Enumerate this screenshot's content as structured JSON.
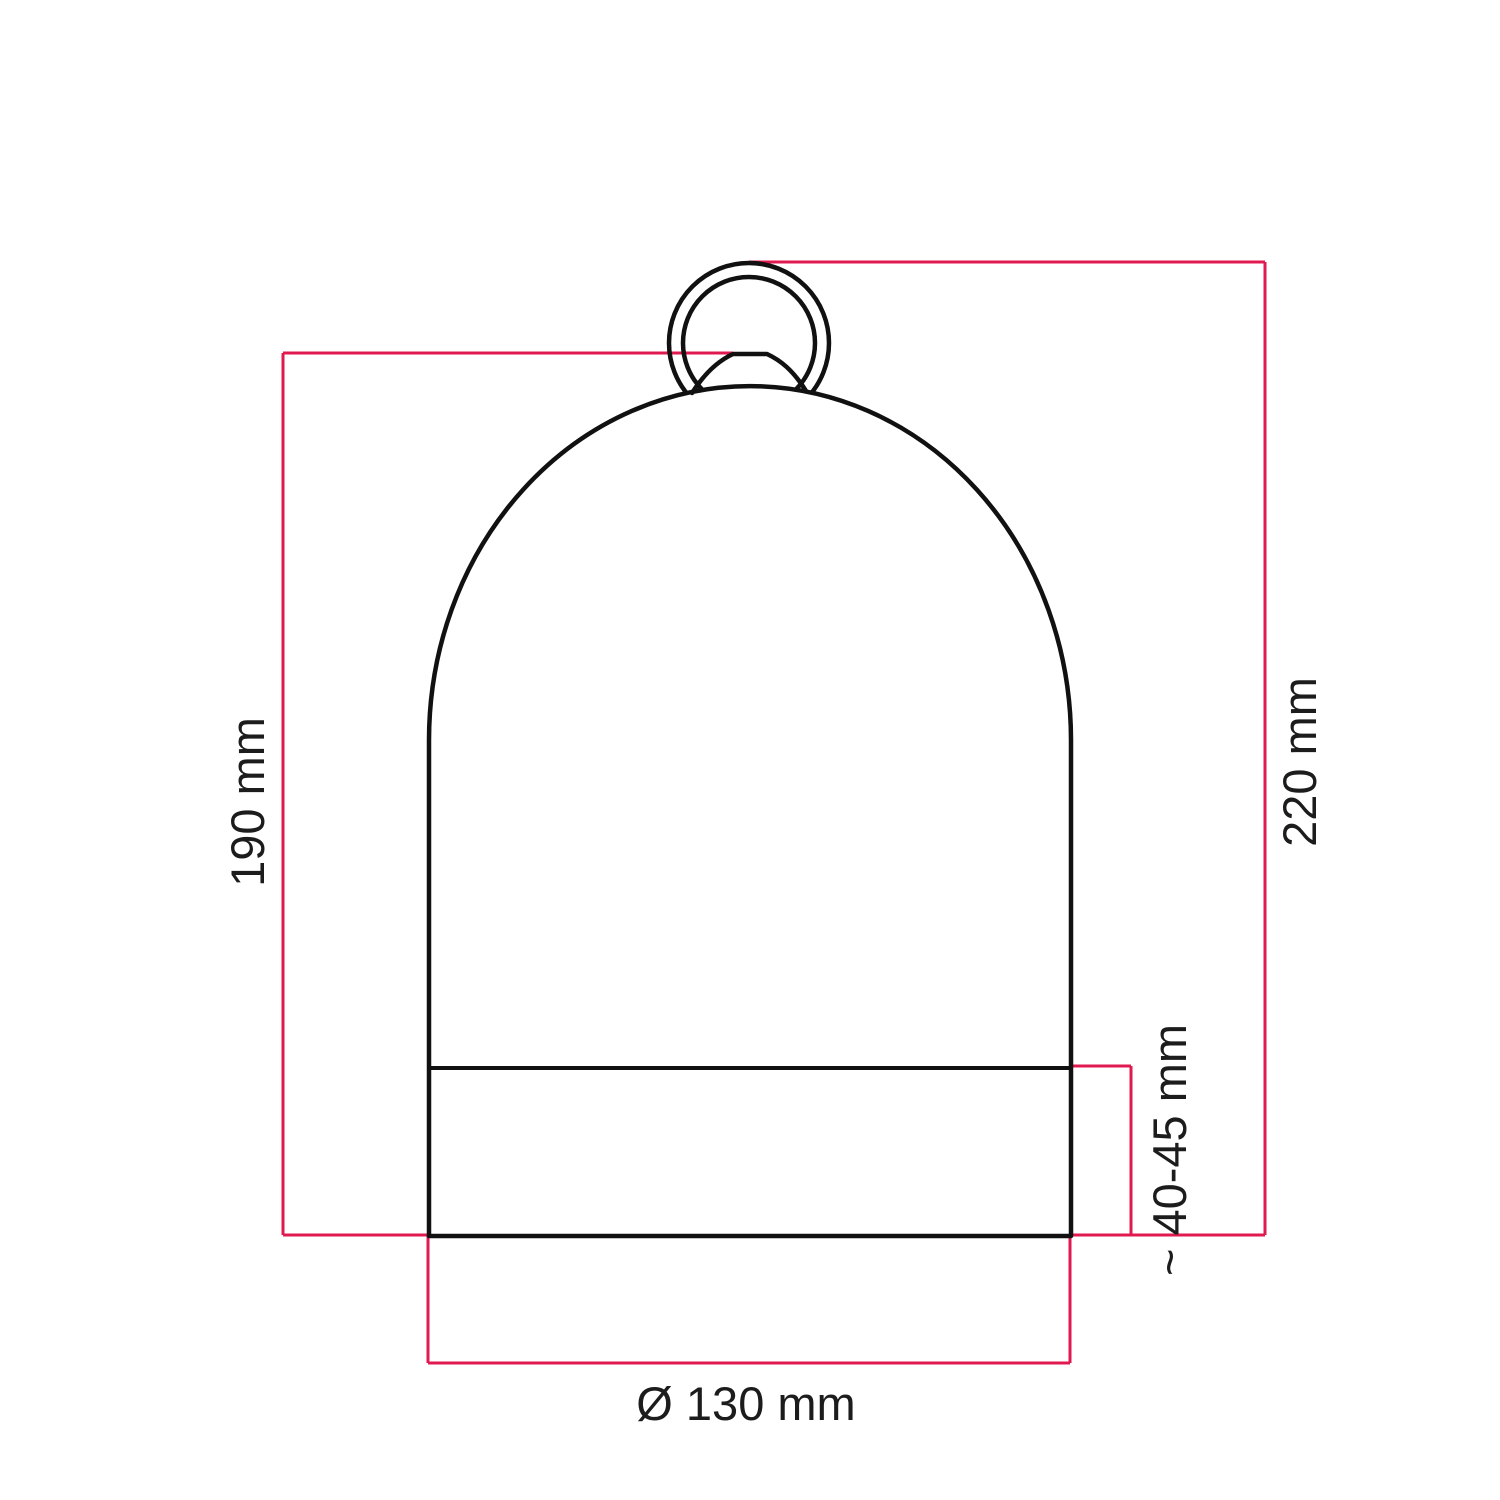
{
  "diagram": {
    "labels": {
      "body_height": "190 mm",
      "total_height": "220 mm",
      "socket_height": "~ 40-45 mm",
      "diameter": "Ø 130 mm"
    },
    "colors": {
      "dimension_line": "#e01950",
      "outline": "#111111",
      "label_text": "#1c1c1c",
      "background": "#ffffff"
    }
  }
}
